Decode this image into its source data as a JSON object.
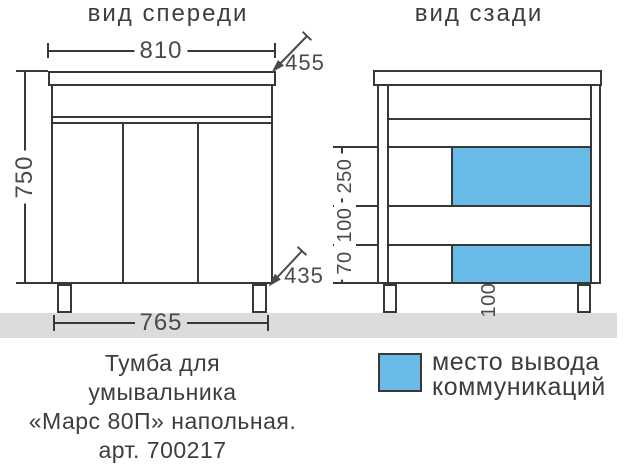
{
  "front_view": {
    "title": "вид спереди",
    "dim_width_top": "810",
    "dim_depth_top": "455",
    "dim_height": "750",
    "dim_width_bottom": "765",
    "dim_depth_bottom": "435"
  },
  "back_view": {
    "title": "вид сзади",
    "dim_zone_upper": "250",
    "dim_zone_gap": "100",
    "dim_zone_lower": "70",
    "dim_leg_height": "100"
  },
  "legend": {
    "lines": [
      "место вывода",
      "коммуникаций"
    ]
  },
  "caption": {
    "lines": [
      "Тумба для",
      "умывальника",
      "«Марс 80П» напольная.",
      "арт. 700217"
    ]
  },
  "colors": {
    "communication_zone": "#67bbe6",
    "floor": "#dcdcdc",
    "line": "#383838"
  }
}
